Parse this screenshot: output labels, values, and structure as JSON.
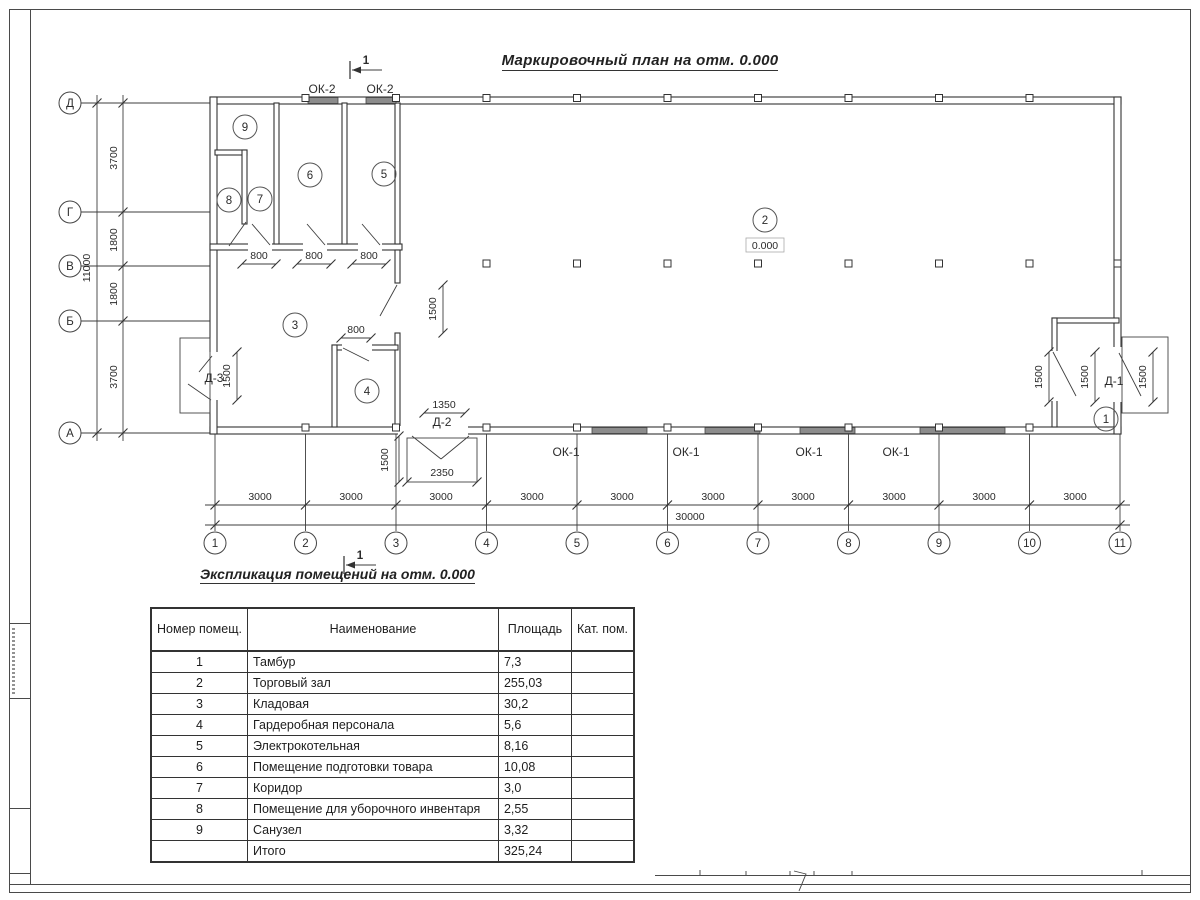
{
  "sheet": {
    "title": "Маркировочный план на отм. 0.000",
    "section_mark": "1"
  },
  "axes": {
    "rows": [
      "Д",
      "Г",
      "В",
      "Б",
      "А"
    ],
    "cols": [
      "1",
      "2",
      "3",
      "4",
      "5",
      "6",
      "7",
      "8",
      "9",
      "10",
      "11"
    ]
  },
  "dims": {
    "left_total": "11000",
    "left_segments": [
      "3700",
      "1800",
      "1800",
      "3700"
    ],
    "bottom_segment": "3000",
    "bottom_total": "30000",
    "door800": "800",
    "dim1500": "1500",
    "d2_width": "1350",
    "d2_porch": "2350"
  },
  "plan": {
    "elevation": "0.000",
    "rooms": [
      "1",
      "2",
      "3",
      "4",
      "5",
      "6",
      "7",
      "8",
      "9"
    ],
    "window_labels": {
      "ok1": "ОК-1",
      "ok2": "ОК-2"
    },
    "door_labels": {
      "d1": "Д-1",
      "d2": "Д-2",
      "d3": "Д-3"
    }
  },
  "table": {
    "title": "Экспликация помещений на отм. 0.000",
    "headers": {
      "number": "Номер помещ.",
      "name": "Наименование",
      "area": "Площадь",
      "category": "Кат. пом."
    },
    "rows": [
      {
        "number": "1",
        "name": "Тамбур",
        "area": "7,3",
        "category": ""
      },
      {
        "number": "2",
        "name": "Торговый зал",
        "area": "255,03",
        "category": ""
      },
      {
        "number": "3",
        "name": "Кладовая",
        "area": "30,2",
        "category": ""
      },
      {
        "number": "4",
        "name": "Гардеробная персонала",
        "area": "5,6",
        "category": ""
      },
      {
        "number": "5",
        "name": "Электрокотельная",
        "area": "8,16",
        "category": ""
      },
      {
        "number": "6",
        "name": "Помещение подготовки товара",
        "area": "10,08",
        "category": ""
      },
      {
        "number": "7",
        "name": "Коридор",
        "area": "3,0",
        "category": ""
      },
      {
        "number": "8",
        "name": "Помещение для уборочного инвентаря",
        "area": "2,55",
        "category": ""
      },
      {
        "number": "9",
        "name": "Санузел",
        "area": "3,32",
        "category": ""
      },
      {
        "number": "",
        "name": "Итого",
        "area": "325,24",
        "category": ""
      }
    ]
  }
}
